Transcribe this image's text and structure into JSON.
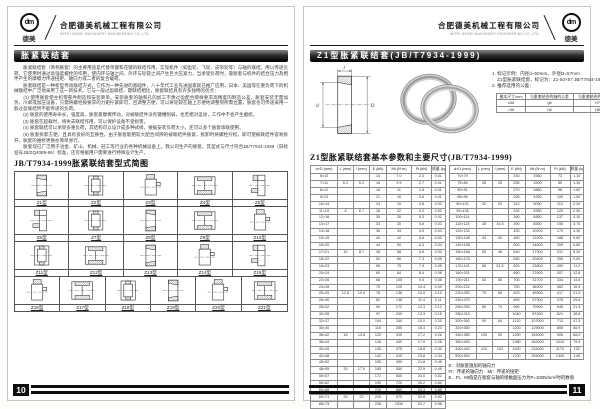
{
  "header": {
    "company_cn": "合肥德美机械工程有限公司",
    "company_en": "HEFEI DEMEI MACHINERY ENGINEERING CO.,LTD.",
    "logo_mark": "dm",
    "logo_text": "德美"
  },
  "left_page": {
    "page_number": "10",
    "banner": "胀紧联结套",
    "paragraphs": [
      "　　胀紧联结套（简称胀套）的主要用途是代替单键和花键的联结作用，实现机件（如齿轮、飞轮、皮带轮等）与轴的联结，用以传递负荷。它使用时通过高强度螺栓的作用，使内环与轴之间、外环与轮毂之间产生巨大压紧力，当承受负荷时，靠胀套与机件的结合压力及相伴产生的摩擦力传递扭矩、轴向力或二者的复合载荷。",
      "　　胀套联结是一种新型传动联结方式，它作为一种先进的基础件，八十年代工业先进国家就已推广应用，日本、美国等在重负荷下的机械联结中广泛地采用了这一新技术。它与一般过盈联结、键联结相比，胀套联结具有许多独特的优点：",
      "　　(1) 使用胀套使主机零部件制造和安装简单。安装胀套的轴和孔的加工不像过盈配合那样要求高精度的制造公差，胀套安装无需加热、冷却或加压设备，只需将螺栓按要求的力矩拧紧即可，且调整方便，可以将轮毂在轴上方便地调整到所需位置，胀套也可传递采用一般过盈联结所不能传递的负荷。",
      "　　(2) 胀套的使用寿命长，强度高。胀套靠摩擦传动，对被联结件没有键槽削弱，也无相对运动，工作中不会产生磨损。",
      "　　(3) 胀套在超载时，将失去联结作用，可以保护设备不受损害。",
      "　　(4) 胀套联结可以承受多重负荷，其结构可以设计成多种式样，根据安装负荷大小，还可以多个胀套串联使用。",
      "　　(5) 胀套拆卸方便，且具有良好的互换性。由于胀套能把较大配合间隙的被联结件胀紧，拆卸时将螺栓拧松，即可使被联结件容易拆开，胀套的维修更换亦简单易行。",
      "　　胀套现已广泛用于冶金、矿山、机械、轻工等行业的各种机械设备上。我公司生产的胀套，其型式与尺寸符合JB/T7934-1999（旧标准号JB/ZQ4089-86）标准，还可根据用户需要进行特殊设计生产。"
    ],
    "section_title": "JB/T7934-1999胀紧联结套型式简图",
    "type_grid": {
      "rows": [
        [
          {
            "label": "Z1型",
            "icon": "sleeve-a"
          },
          {
            "label": "Z2型",
            "icon": "sleeve-b"
          },
          {
            "label": "Z3型",
            "icon": "sleeve-e"
          },
          {
            "label": "Z4型",
            "icon": "sleeve-d"
          },
          {
            "label": "Z5型",
            "icon": "sleeve-c"
          }
        ],
        [
          {
            "label": "Z6型",
            "icon": "sleeve-c"
          },
          {
            "label": "Z7型",
            "icon": "sleeve-b"
          },
          {
            "label": "Z8型",
            "icon": "sleeve-a"
          },
          {
            "label": "Z9型",
            "icon": "sleeve-d"
          },
          {
            "label": "Z10型",
            "icon": "sleeve-e"
          }
        ],
        [
          {
            "label": "Z11型",
            "icon": "sleeve-b"
          },
          {
            "label": "Z12型",
            "icon": "sleeve-d"
          },
          {
            "label": "Z13型",
            "icon": "sleeve-a"
          },
          {
            "label": "Z14型",
            "icon": "sleeve-e"
          },
          {
            "label": "Z15型",
            "icon": "sleeve-c"
          }
        ],
        [
          {
            "label": "Z16型",
            "icon": "sleeve-e"
          },
          {
            "label": "Z17型",
            "icon": "sleeve-d"
          },
          {
            "label": "Z18型",
            "icon": "sleeve-b"
          },
          {
            "label": "Z19型",
            "icon": "sleeve-a"
          },
          {
            "label": "Z20型",
            "icon": "sleeve-e"
          },
          {
            "label": "Z21型",
            "icon": "sleeve-d"
          }
        ]
      ]
    }
  },
  "right_page": {
    "page_number": "11",
    "banner": "Z1型胀紧联结套(JB/T7934-1999)",
    "figure": {
      "dim_l": "l",
      "dim_d": "d",
      "dim_D": "D"
    },
    "notes_top": [
      "1. 标记示例：内径d=50mm，外径D=57mm",
      "    Z1型胀紧联结套，标记为：Z1-50×57 JB/T7934-1999",
      "2. 推荐选用的公差："
    ],
    "tolerance_table": {
      "header": [
        "基本尺寸/mm",
        "与胀套结合的轴的公差",
        "与胀套结合的孔的公差"
      ],
      "rows": [
        [
          "≤38",
          "g6",
          "H7"
        ],
        [
          ">38",
          "h8",
          "H8"
        ]
      ]
    },
    "section_title": "Z1型胀紧联结套基本参数和主要尺寸(JB/T7934-1999)",
    "main_table": {
      "header": [
        "d×D (mm)",
        "L (mm)",
        "l (mm)",
        "E (kN)",
        "Mt (N·m)",
        "Ft (kN)",
        "质量 (kg)"
      ],
      "left_rows": [
        [
          "6×10",
          "",
          "",
          "14",
          "7.0",
          "2.3",
          "0.01"
        ],
        [
          "7×11",
          "6.3",
          "5.3",
          "16",
          "9.5",
          "2.7",
          "0.01"
        ],
        [
          "8×12",
          "",
          "",
          "18",
          "11",
          "2.8",
          "0.01"
        ],
        [
          "9×13",
          "",
          "",
          "21",
          "16",
          "3.6",
          "0.01"
        ],
        [
          "10×14",
          "",
          "",
          "24",
          "19",
          "3.8",
          "0.02"
        ],
        [
          "11×15",
          "8",
          "6.7",
          "26",
          "22",
          "4.0",
          "0.02"
        ],
        [
          "12×16",
          "",
          "",
          "30",
          "26",
          "4.3",
          "0.02"
        ],
        [
          "13×17",
          "",
          "",
          "33",
          "30",
          "4.6",
          "0.03"
        ],
        [
          "14×18",
          "",
          "",
          "36",
          "34",
          "4.9",
          "0.03"
        ],
        [
          "15×19",
          "",
          "",
          "40",
          "42",
          "5.6",
          "0.03"
        ],
        [
          "16×20",
          "",
          "",
          "44",
          "50",
          "6.3",
          "0.04"
        ],
        [
          "17×21",
          "10",
          "8.7",
          "48",
          "58",
          "6.8",
          "0.04"
        ],
        [
          "18×22",
          "",
          "",
          "52",
          "66",
          "7.3",
          "0.05"
        ],
        [
          "19×23",
          "",
          "",
          "56",
          "75",
          "7.9",
          "0.05"
        ],
        [
          "20×24",
          "",
          "",
          "60",
          "84",
          "8.4",
          "0.06"
        ],
        [
          "22×26",
          "",
          "",
          "68",
          "105",
          "9.5",
          "0.08"
        ],
        [
          "24×28",
          "",
          "",
          "75",
          "125",
          "10.4",
          "0.09"
        ],
        [
          "25×29",
          "12.5",
          "10.4",
          "78",
          "136",
          "10.9",
          "0.10"
        ],
        [
          "26×30",
          "",
          "",
          "82",
          "148",
          "11.4",
          "0.11"
        ],
        [
          "28×32",
          "",
          "",
          "90",
          "172",
          "12.3",
          "0.12"
        ],
        [
          "30×35",
          "",
          "",
          "97",
          "200",
          "13.3",
          "0.15"
        ],
        [
          "32×37",
          "",
          "",
          "104",
          "240",
          "15.0",
          "0.20"
        ],
        [
          "35×40",
          "",
          "",
          "115",
          "285",
          "16.3",
          "0.23"
        ],
        [
          "36×42",
          "16",
          "13.8",
          "120",
          "310",
          "17.2",
          "0.26"
        ],
        [
          "38×44",
          "",
          "",
          "128",
          "340",
          "17.9",
          "0.28"
        ],
        [
          "40×45",
          "",
          "",
          "135",
          "375",
          "18.8",
          "0.30"
        ],
        [
          "42×48",
          "",
          "",
          "142",
          "415",
          "19.8",
          "0.34"
        ],
        [
          "45×52",
          "",
          "",
          "155",
          "490",
          "21.8",
          "0.45"
        ],
        [
          "48×55",
          "20",
          "17.5",
          "165",
          "550",
          "22.9",
          "0.49"
        ],
        [
          "50×57",
          "",
          "",
          "172",
          "600",
          "24.0",
          "0.52"
        ],
        [
          "55×62",
          "",
          "",
          "190",
          "720",
          "26.2",
          "0.60"
        ],
        [
          "60×68",
          "",
          "",
          "210",
          "880",
          "29.3",
          "0.85"
        ],
        [
          "63×71",
          "25",
          "22",
          "220",
          "970",
          "30.8",
          "0.92"
        ],
        [
          "65×73",
          "",
          "",
          "228",
          "1030",
          "31.7",
          "0.98"
        ]
      ],
      "right_rows": [
        [
          "70×79",
          "",
          "",
          "240",
          "2550",
          "73",
          "1.10"
        ],
        [
          "75×84",
          "28",
          "25",
          "255",
          "3200",
          "85",
          "1.30"
        ],
        [
          "80×91",
          "",
          "",
          "270",
          "3850",
          "96",
          "1.60"
        ],
        [
          "85×96",
          "",
          "",
          "290",
          "4250",
          "100",
          "1.90"
        ],
        [
          "90×101",
          "32",
          "29",
          "310",
          "5050",
          "112",
          "2.20"
        ],
        [
          "95×106",
          "",
          "",
          "330",
          "5950",
          "125",
          "2.50"
        ],
        [
          "100×114",
          "",
          "",
          "360",
          "6850",
          "137",
          "3.10"
        ],
        [
          "110×124",
          "38",
          "34.5",
          "390",
          "8500",
          "155",
          "3.70"
        ],
        [
          "120×134",
          "",
          "",
          "420",
          "10200",
          "170",
          "4.30"
        ],
        [
          "130×148",
          "44",
          "40",
          "460",
          "12200",
          "188",
          "5.60"
        ],
        [
          "140×158",
          "",
          "",
          "500",
          "14600",
          "209",
          "6.80"
        ],
        [
          "150×168",
          "50",
          "46",
          "540",
          "17300",
          "231",
          "8.20"
        ],
        [
          "160×178",
          "",
          "",
          "580",
          "20400",
          "255",
          "9.60"
        ],
        [
          "170×191",
          "56",
          "51.5",
          "620",
          "23800",
          "280",
          "11.2"
        ],
        [
          "180×201",
          "",
          "",
          "660",
          "27600",
          "307",
          "12.8"
        ],
        [
          "190×211",
          "63",
          "58",
          "700",
          "31700",
          "334",
          "14.6"
        ],
        [
          "200×224",
          "",
          "",
          "750",
          "36200",
          "362",
          "16.5"
        ],
        [
          "220×250",
          "70",
          "65",
          "820",
          "45900",
          "417",
          "21.0"
        ],
        [
          "240×270",
          "",
          "",
          "890",
          "57300",
          "478",
          "25.8"
        ],
        [
          "260×290",
          "80",
          "74",
          "960",
          "70900",
          "545",
          "31.5"
        ],
        [
          "280×315",
          "",
          "",
          "1040",
          "87400",
          "621",
          "38.8"
        ],
        [
          "300×340",
          "90",
          "84",
          "1120",
          "107000",
          "713",
          "47.5"
        ],
        [
          "320×360",
          "",
          "",
          "1200",
          "129000",
          "806",
          "56.9"
        ],
        [
          "340×380",
          "100",
          "93",
          "1290",
          "154000",
          "906",
          "68.0"
        ],
        [
          "360×400",
          "",
          "",
          "1380",
          "182000",
          "1010",
          "79.5"
        ],
        [
          "400×440",
          "110",
          "103",
          "1520",
          "234000",
          "1170",
          "102"
        ],
        [
          "500×540",
          "",
          "",
          "1700",
          "294000",
          "1340",
          "148"
        ]
      ]
    },
    "notes_bottom": [
      "E：对胀套施加的轴向力",
      "Ft：传递的轴向力　Mt：传递的扭矩",
      "E、Ft、Mt值是在胀套与轴的接触面压力为P=100N/mm²时的数值"
    ]
  }
}
